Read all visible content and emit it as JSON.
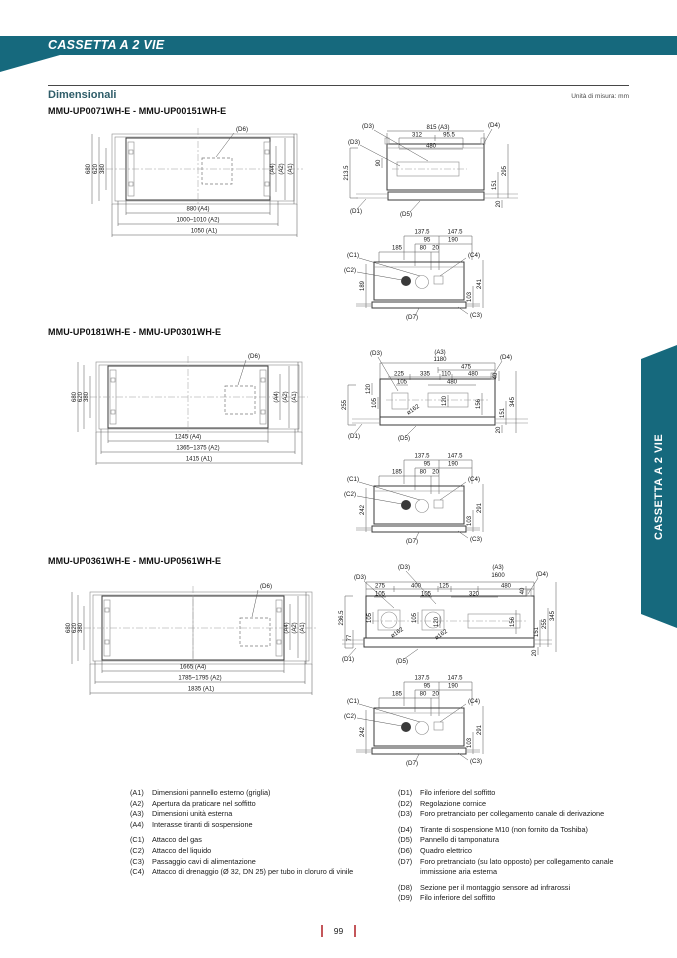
{
  "page": {
    "header_title": "CASSETTA A 2 VIE",
    "section_label": "Dimensionali",
    "units_note": "Unità di misura: mm",
    "side_tab": "CASSETTA A 2 VIE",
    "page_number": "99"
  },
  "colors": {
    "teal": "#16697d",
    "page_marker_red": "#c4565a"
  },
  "sections": [
    {
      "model": "MMU-UP0071WH-E - MMU-UP00151WH-E",
      "plan": {
        "d1": "680",
        "d2": "620",
        "d3": "380",
        "r1": "(A4)",
        "r2": "(A2)",
        "r3": "(A1)",
        "b1": "880 (A4)",
        "b2": "1000–1010 (A2)",
        "b3": "1050 (A1)",
        "box": "(D6)"
      },
      "side": {
        "a3": "815 (A3)",
        "w1": "312",
        "w2": "95.5",
        "w3": "480",
        "h1": "90",
        "left": "213.5",
        "r1": "295",
        "r2": "151",
        "r3": "20",
        "d3a": "(D3)",
        "d3b": "(D3)",
        "d4": "(D4)",
        "d1": "(D1)",
        "d5": "(D5)"
      },
      "detail": {
        "t1": "137.5",
        "t2": "147.5",
        "t3": "95",
        "t4": "190",
        "t5": "185",
        "t6": "80",
        "t7": "20",
        "c1": "(C1)",
        "c2": "(C2)",
        "c3": "(C3)",
        "c4": "(C4)",
        "d7": "(D7)",
        "left": "189",
        "right": "241",
        "inner": "103"
      }
    },
    {
      "model": "MMU-UP0181WH-E - MMU-UP0301WH-E",
      "plan": {
        "d1": "680",
        "d2": "620",
        "d3": "380",
        "r1": "(A4)",
        "r2": "(A2)",
        "r3": "(A1)",
        "b1": "1245 (A4)",
        "b2": "1365~1375 (A2)",
        "b3": "1415 (A1)",
        "box": "(D6)"
      },
      "side": {
        "a3": "(A3)",
        "a3v": "1180",
        "sub": "475",
        "w1": "225",
        "w2": "335",
        "w3": "110",
        "w4": "480",
        "w5": "105",
        "w6": "480",
        "h1": "40",
        "l1": "120",
        "l2": "105",
        "mid1": "120",
        "mid2": "156",
        "dia": "ø162",
        "far": "255",
        "r1": "151",
        "r2": "345",
        "r3": "20",
        "d3": "(D3)",
        "d4": "(D4)",
        "d1": "(D1)",
        "d5": "(D5)"
      },
      "detail": {
        "t1": "137.5",
        "t2": "147.5",
        "t3": "95",
        "t4": "190",
        "t5": "185",
        "t6": "80",
        "t7": "20",
        "c1": "(C1)",
        "c2": "(C2)",
        "c3": "(C3)",
        "c4": "(C4)",
        "d7": "(D7)",
        "left": "242",
        "right": "291",
        "inner": "103"
      }
    },
    {
      "model": "MMU-UP0361WH-E - MMU-UP0561WH-E",
      "plan": {
        "d1": "680",
        "d2": "620",
        "d3": "380",
        "r1": "(A4)",
        "r2": "(A2)",
        "r3": "(A1)",
        "b1": "1665 (A4)",
        "b2": "1785~1795 (A2)",
        "b3": "1835 (A1)",
        "box": "(D6)"
      },
      "side": {
        "a3": "(A3)",
        "a3v": "1600",
        "w1": "275",
        "w2": "400",
        "w3": "125",
        "w4": "480",
        "w5": "105",
        "w6": "105",
        "w7": "320",
        "h1": "40",
        "l1": "105",
        "l2": "105",
        "mid1": "120",
        "mid2": "156",
        "dia1": "ø162",
        "dia2": "ø162",
        "far": "236.5",
        "far2": "77",
        "r1": "151",
        "r2": "255",
        "r3": "345",
        "r4": "20",
        "d3a": "(D3)",
        "d3b": "(D3)",
        "d4": "(D4)",
        "d1": "(D1)",
        "d5": "(D5)"
      },
      "detail": {
        "t1": "137.5",
        "t2": "147.5",
        "t3": "95",
        "t4": "190",
        "t5": "185",
        "t6": "80",
        "t7": "20",
        "c1": "(C1)",
        "c2": "(C2)",
        "c3": "(C3)",
        "c4": "(C4)",
        "d7": "(D7)",
        "left": "242",
        "right": "291",
        "inner": "103"
      }
    }
  ],
  "legend": {
    "left": [
      {
        "ref": "(A1)",
        "text": "Dimensioni pannello esterno (griglia)"
      },
      {
        "ref": "(A2)",
        "text": "Apertura da praticare nel soffitto"
      },
      {
        "ref": "(A3)",
        "text": "Dimensioni unità esterna"
      },
      {
        "ref": "(A4)",
        "text": "Interasse tiranti di sospensione"
      },
      {
        "ref": "(C1)",
        "text": "Attacco del gas"
      },
      {
        "ref": "(C2)",
        "text": "Attacco del liquido"
      },
      {
        "ref": "(C3)",
        "text": "Passaggio cavi di alimentazione"
      },
      {
        "ref": "(C4)",
        "text": "Attacco di drenaggio (Ø 32, DN 25) per tubo in cloruro di vinile"
      }
    ],
    "right": [
      {
        "ref": "(D1)",
        "text": "Filo inferiore del soffitto"
      },
      {
        "ref": "(D2)",
        "text": "Regolazione cornice"
      },
      {
        "ref": "(D3)",
        "text": "Foro pretranciato per collegamento canale di derivazione"
      },
      {
        "ref": "(D4)",
        "text": "Tirante di sospensione M10 (non fornito da Toshiba)"
      },
      {
        "ref": "(D5)",
        "text": "Pannello di tamponatura"
      },
      {
        "ref": "(D6)",
        "text": "Quadro elettrico"
      },
      {
        "ref": "(D7)",
        "text": "Foro pretranciato (su lato opposto) per collegamento canale immissione aria esterna"
      },
      {
        "ref": "(D8)",
        "text": "Sezione per il montaggio sensore ad infrarossi"
      },
      {
        "ref": "(D9)",
        "text": "Filo inferiore del soffitto"
      }
    ]
  }
}
